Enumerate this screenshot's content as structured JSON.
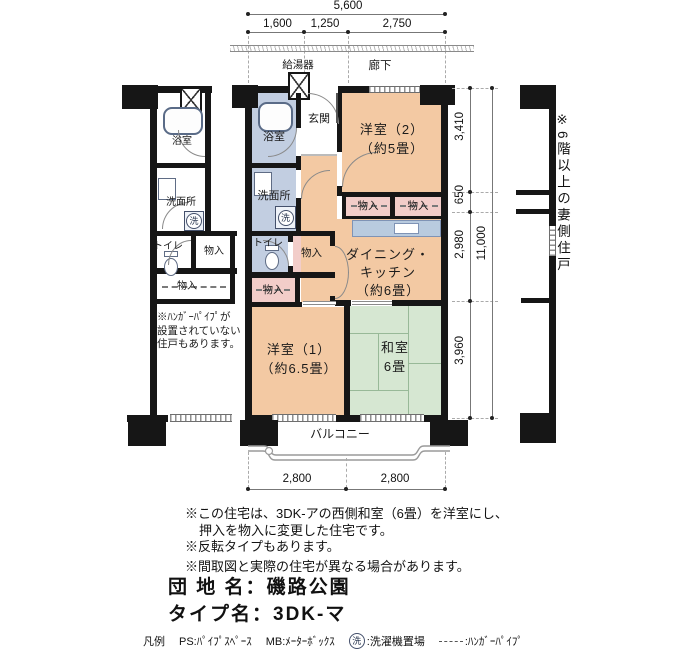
{
  "colors": {
    "wall": "#161616",
    "western_room": "#f3c9a3",
    "wet_room": "#c2cee1",
    "closet": "#f2cdc9",
    "tatami": "#d6e7d2",
    "counter": "#b9cbdf"
  },
  "dims_top": {
    "total": "5,600",
    "segs": [
      "1,600",
      "1,250",
      "2,750"
    ]
  },
  "dims_right": {
    "segs": [
      "3,410",
      "650",
      "2,980",
      "3,960"
    ],
    "total": "11,000"
  },
  "dims_bottom": {
    "segs": [
      "2,800",
      "2,800"
    ]
  },
  "plan": {
    "corridor": "廊下",
    "water_heater": "給湯器",
    "entrance": "玄関",
    "bath": "浴室",
    "washroom": "洗面所",
    "toilet": "トイレ",
    "closet": "物入",
    "western2_name": "洋室（2）",
    "western2_size": "（約5畳）",
    "dk_line1": "ダイニング・",
    "dk_line2": "キッチン",
    "dk_size": "（約6畳）",
    "western1_name": "洋室（1）",
    "western1_size": "（約6.5畳）",
    "japanese_name": "和室",
    "japanese_size": "6畳",
    "balcony": "バルコニー",
    "washer_mark": "洗"
  },
  "neighbor": {
    "bath": "浴室",
    "washroom": "洗面所",
    "toilet": "トイレ",
    "closet1": "物入",
    "closet2": "物入",
    "note": "※ﾊﾝｶﾞｰﾊﾟｲﾌﾟが\n設置されていない\n住戸もあります。"
  },
  "side_note": "※6階以上の妻側住戸",
  "notes": [
    "※この住宅は、3DK-アの西側和室（6畳）を洋室にし、",
    "押入を物入に変更した住宅です。",
    "※反転タイプもあります。",
    "※間取図と実際の住宅が異なる場合があります。"
  ],
  "title": {
    "estate_label": "団 地 名：",
    "estate_value": "磯路公園",
    "type_label": "タイプ名：",
    "type_value": "3DK-マ"
  },
  "legend": {
    "heading": "凡例",
    "ps": "PS:ﾊﾟｲﾌﾟｽﾍﾟｰｽ",
    "mb": "MB:ﾒｰﾀｰﾎﾞｯｸｽ",
    "washer_mark": "洗",
    "washer": ":洗濯機置場",
    "hanger": ":ﾊﾝｶﾞｰﾊﾟｲﾌﾟ"
  }
}
